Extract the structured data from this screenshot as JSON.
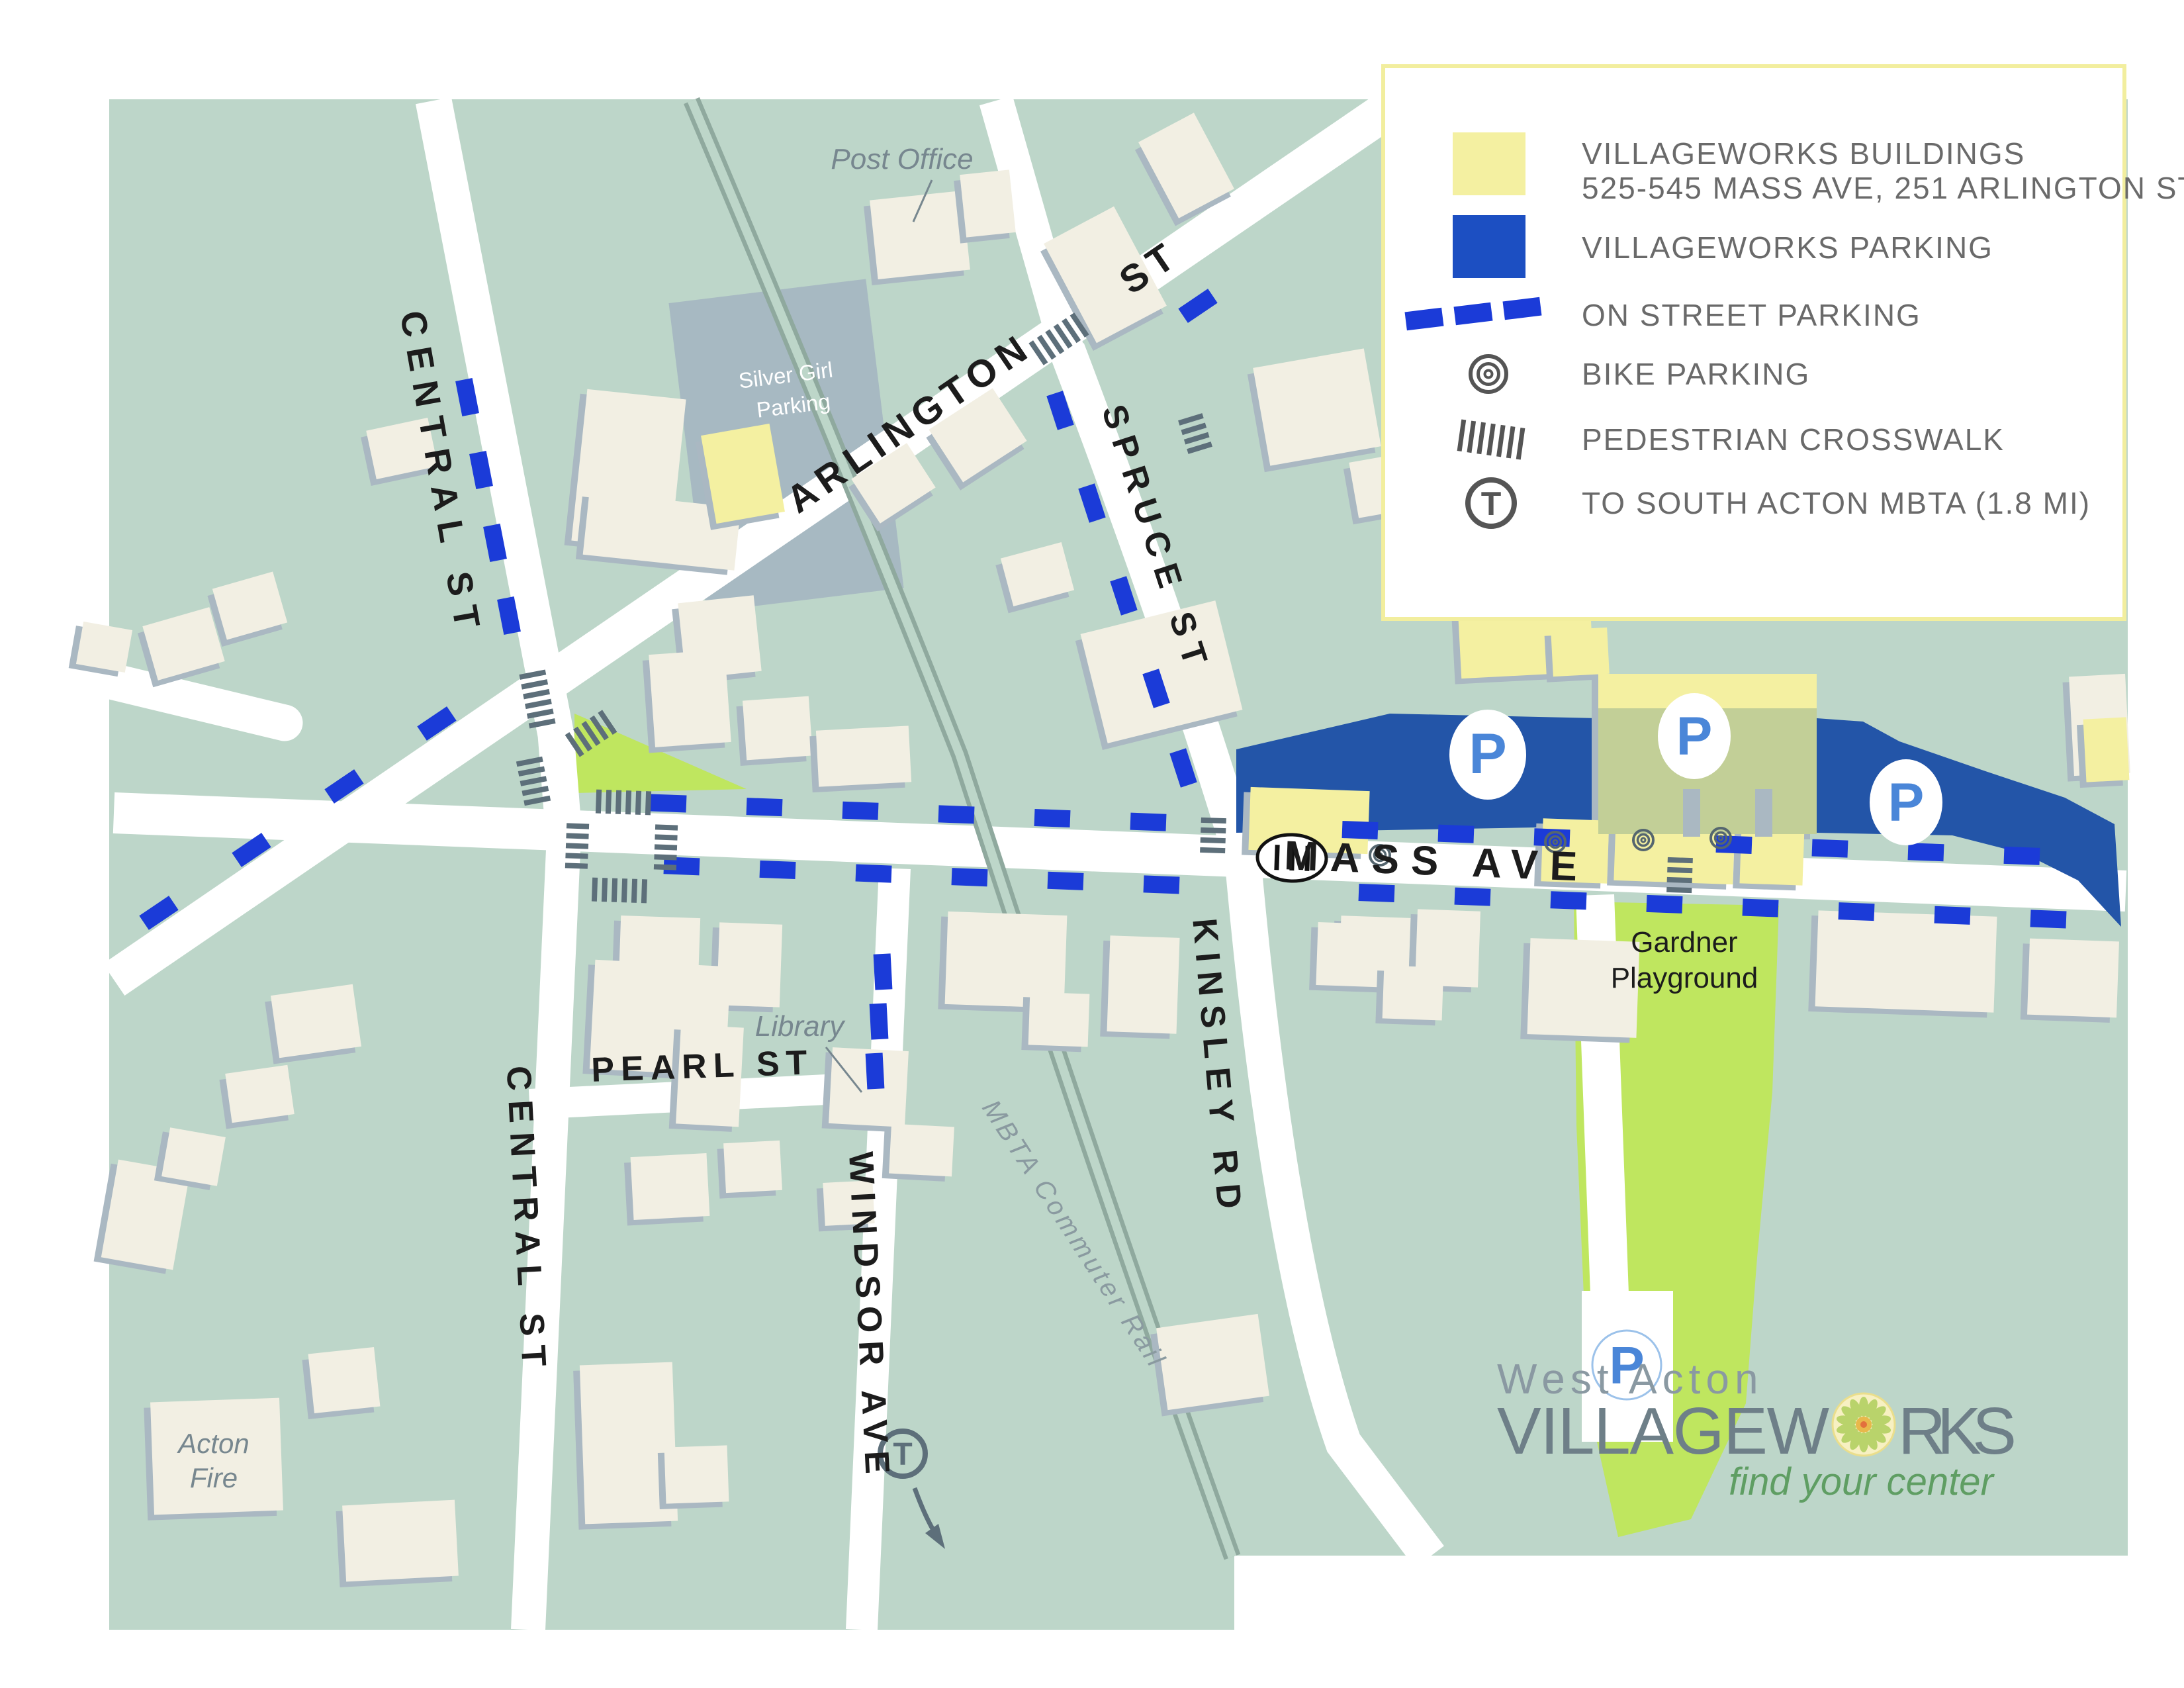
{
  "map": {
    "street_labels": {
      "central_st_upper": "CENTRAL ST",
      "arlington": "ARLINGTON",
      "arlington_st": "ST",
      "spruce_st": "SPRUCE ST",
      "mass_ave": "MASS AVE",
      "kinsley_rd": "KINSLEY RD",
      "central_st_lower": "CENTRAL ST",
      "pearl_st": "PEARL ST",
      "windsor_ave": "WINDSOR AVE",
      "mbta_rail": "MBTA Commuter Rail"
    },
    "place_labels": {
      "post_office": "Post Office",
      "silver_girl_line1": "Silver Girl",
      "silver_girl_line2": "Parking",
      "library": "Library",
      "acton_fire_line1": "Acton",
      "acton_fire_line2": "Fire",
      "gardner_line1": "Gardner",
      "gardner_line2": "Playground"
    },
    "markers": {
      "parking_letter": "P",
      "mbta_letter": "T"
    },
    "colors": {
      "sage": "#bdd6c9",
      "street": "#ffffff",
      "cream": "#f2efe3",
      "shadow": "#aab8c2",
      "vw_yellow": "#f4f0a1",
      "parking_blue": "#2355a8",
      "dash_blue": "#1b3bd8",
      "legend_border": "#f2ee9e",
      "playground_green": "#bfe65f",
      "deck_green": "#c2cf97",
      "rail_green": "#8fa99e",
      "silver_gray": "#a7b9c2",
      "crosswalk_gray": "#5d6f7a",
      "p_blue": "#4a86d8"
    }
  },
  "legend": {
    "items": [
      {
        "label": "VILLAGEWORKS BUILDINGS",
        "sublabel": "525-545 MASS AVE, 251 ARLINGTON ST"
      },
      {
        "label": "VILLAGEWORKS PARKING"
      },
      {
        "label": "ON STREET PARKING"
      },
      {
        "label": "BIKE PARKING"
      },
      {
        "label": "PEDESTRIAN CROSSWALK"
      },
      {
        "label": "TO SOUTH ACTON MBTA (1.8 MI)"
      }
    ]
  },
  "logo": {
    "location": "West Acton",
    "name_part1": "VILLAGEW",
    "name_part2": "RKS",
    "tagline": "find your center"
  }
}
